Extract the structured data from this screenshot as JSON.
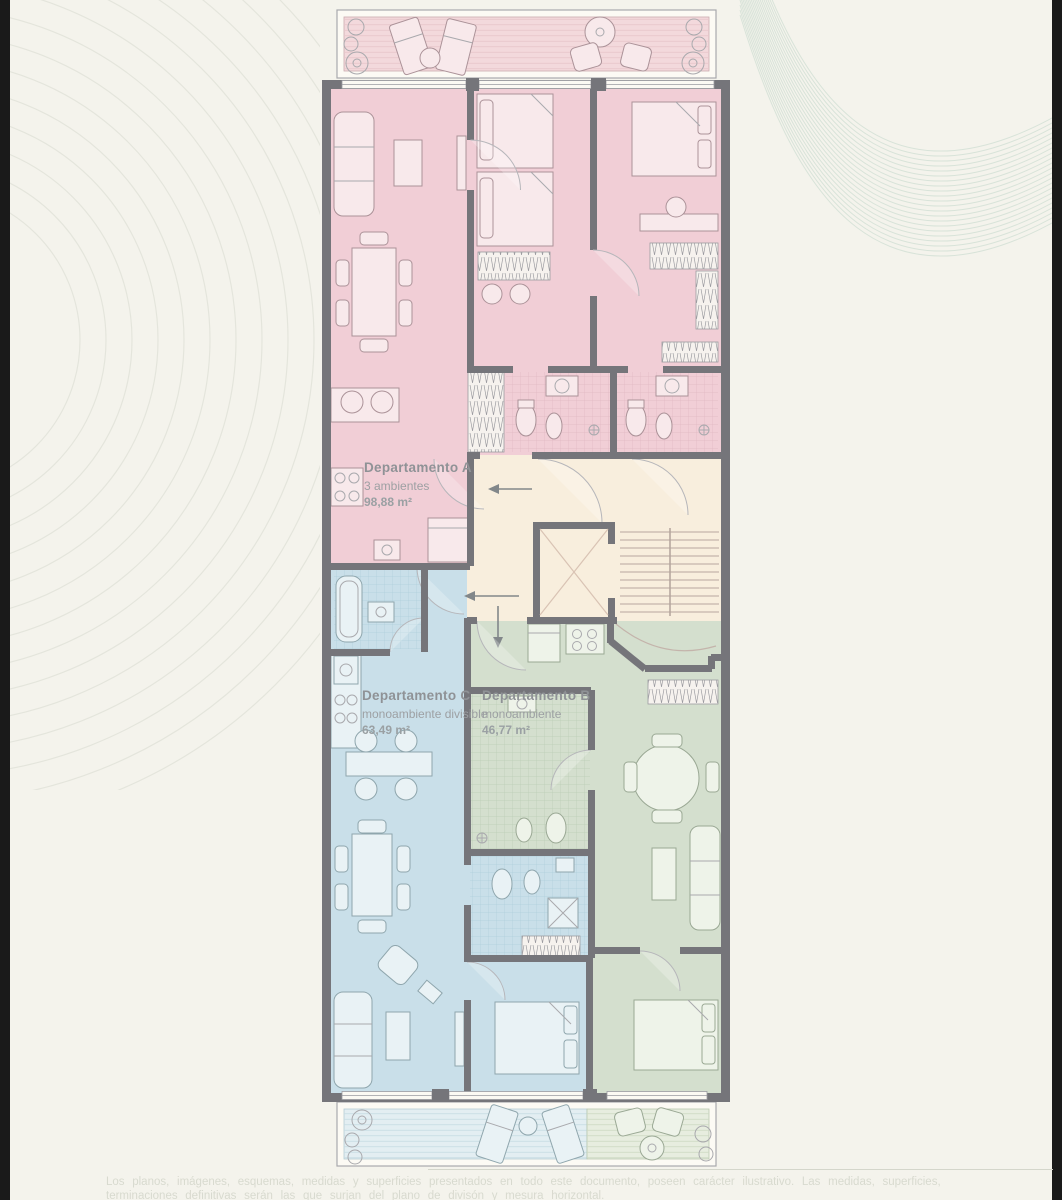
{
  "page": {
    "background": "#f4f3ec"
  },
  "plan": {
    "apartments": [
      {
        "id": "A",
        "name": "Departamento A",
        "type": "3 ambientes",
        "area": "98,88 m²",
        "color": "#f1ced6"
      },
      {
        "id": "B",
        "name": "Departamento B",
        "type": "monoambiente",
        "area": "46,77 m²",
        "color": "#d4dfce"
      },
      {
        "id": "C",
        "name": "Departamento C",
        "type": "monoambiente divisible",
        "area": "63,49 m²",
        "color": "#c9dfe9"
      }
    ],
    "common_area_color": "#f8eedd",
    "wall_color": "#75757a",
    "wave_color": "#d4e1d6"
  },
  "footer": {
    "disclaimer_line1": "Los planos, imágenes, esquemas, medidas y superficies presentados en todo este documento, poseen carácter ilustrativo. Las medidas, superficies,",
    "disclaimer_line2": "terminaciones definitivas serán las que surjan del plano de divisón y mesura horizontal."
  }
}
